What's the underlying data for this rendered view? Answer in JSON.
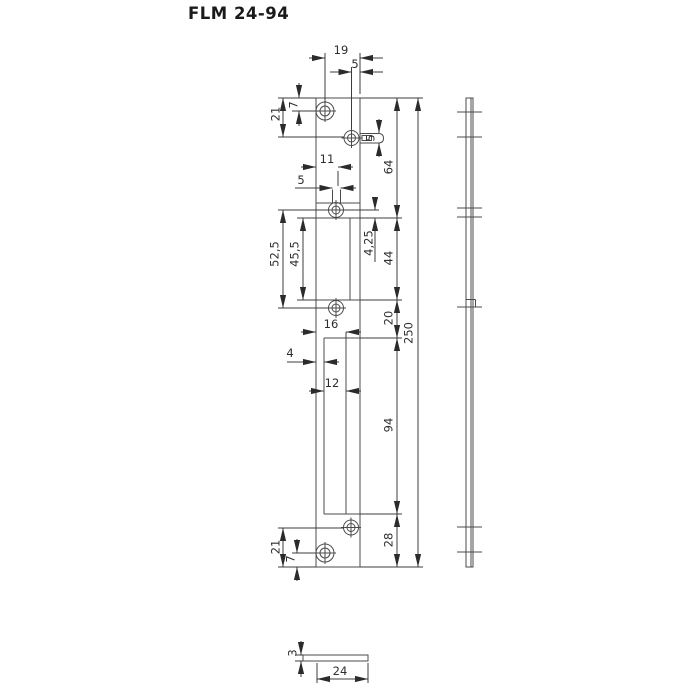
{
  "title": "FLM 24-94",
  "front_view": {
    "dim_labels": {
      "top_width": "19",
      "top_offset": "5",
      "top_hole_y": "7",
      "latch_hole_y": "21",
      "latch_slot_height": "5",
      "mid_slot_offset": "11",
      "mid_slot_width": "5",
      "mid_holes_span": "52,5",
      "recess_height": "45,5",
      "hole_to_recess": "4,25",
      "recess_span": "44",
      "top_to_recess": "64",
      "recess_to_cutout": "20",
      "cutout_left_span": "16",
      "cutout_inset": "4",
      "cutout_width": "12",
      "cutout_height": "94",
      "cutout_to_bottom": "28",
      "total_height": "250",
      "bottom_hole_y": "21",
      "bottom_screw_y": "7"
    }
  },
  "section_view": {
    "dim_labels": {
      "thickness": "3",
      "width": "24"
    }
  }
}
